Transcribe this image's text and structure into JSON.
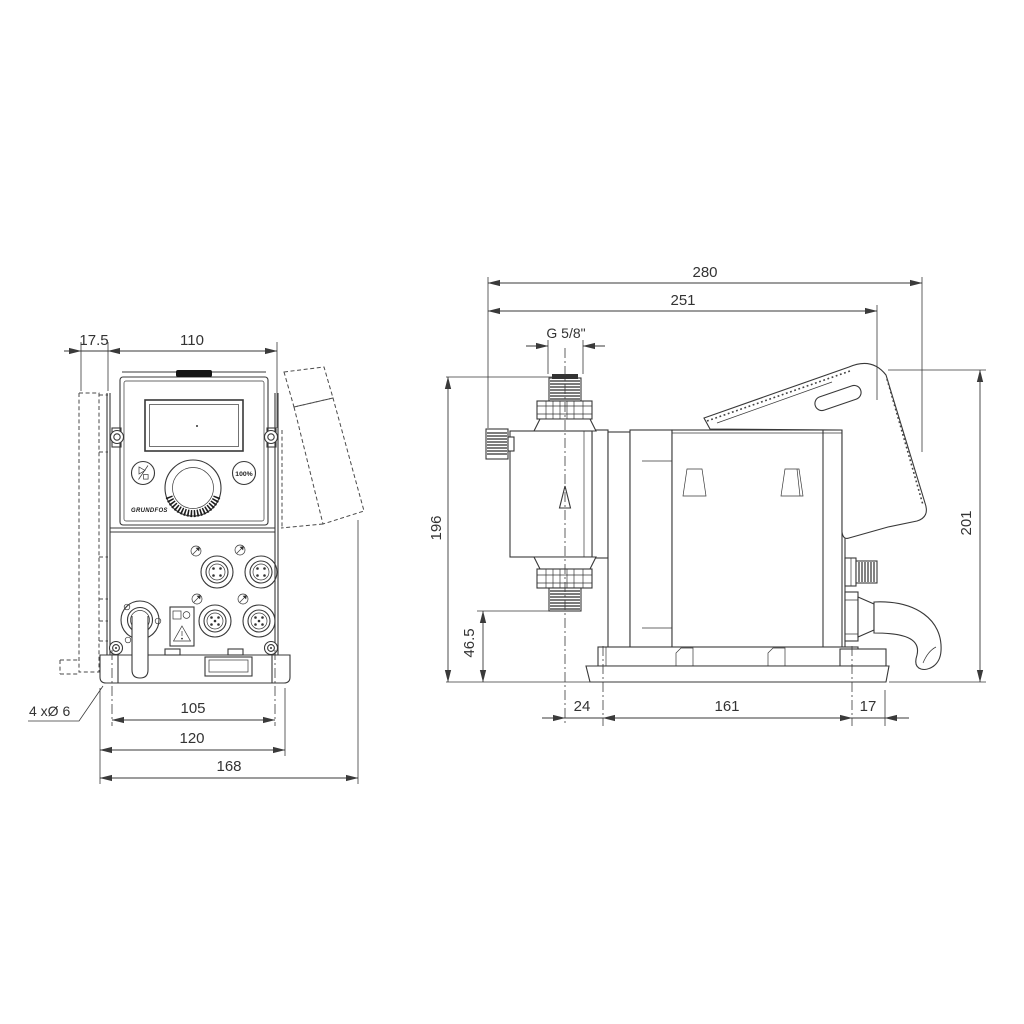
{
  "ink": "#383838",
  "paper": "#ffffff",
  "front": {
    "dim_offset": "17.5",
    "dim_width": "110",
    "dim_hole_span": "105",
    "dim_plate_width": "120",
    "dim_total_width": "168",
    "holes_label": "4 xØ 6",
    "button_100": "100%",
    "logo": "GRUNDFOS"
  },
  "side": {
    "dim_total_depth": "280",
    "dim_depth": "251",
    "thread_label": "G 5/8\"",
    "dim_height": "196",
    "dim_inlet_height": "46.5",
    "dim_front_offset": "24",
    "dim_hole_span": "161",
    "dim_rear_offset": "17",
    "dim_total_height": "201"
  },
  "icons": {
    "start_stop_icon": "play-stop-glyph",
    "capacity_button": "100% label",
    "warning_icon": "warning-triangle",
    "flow_arrow": "up-arrow",
    "connector_icons": "cable-plug-arrows"
  }
}
